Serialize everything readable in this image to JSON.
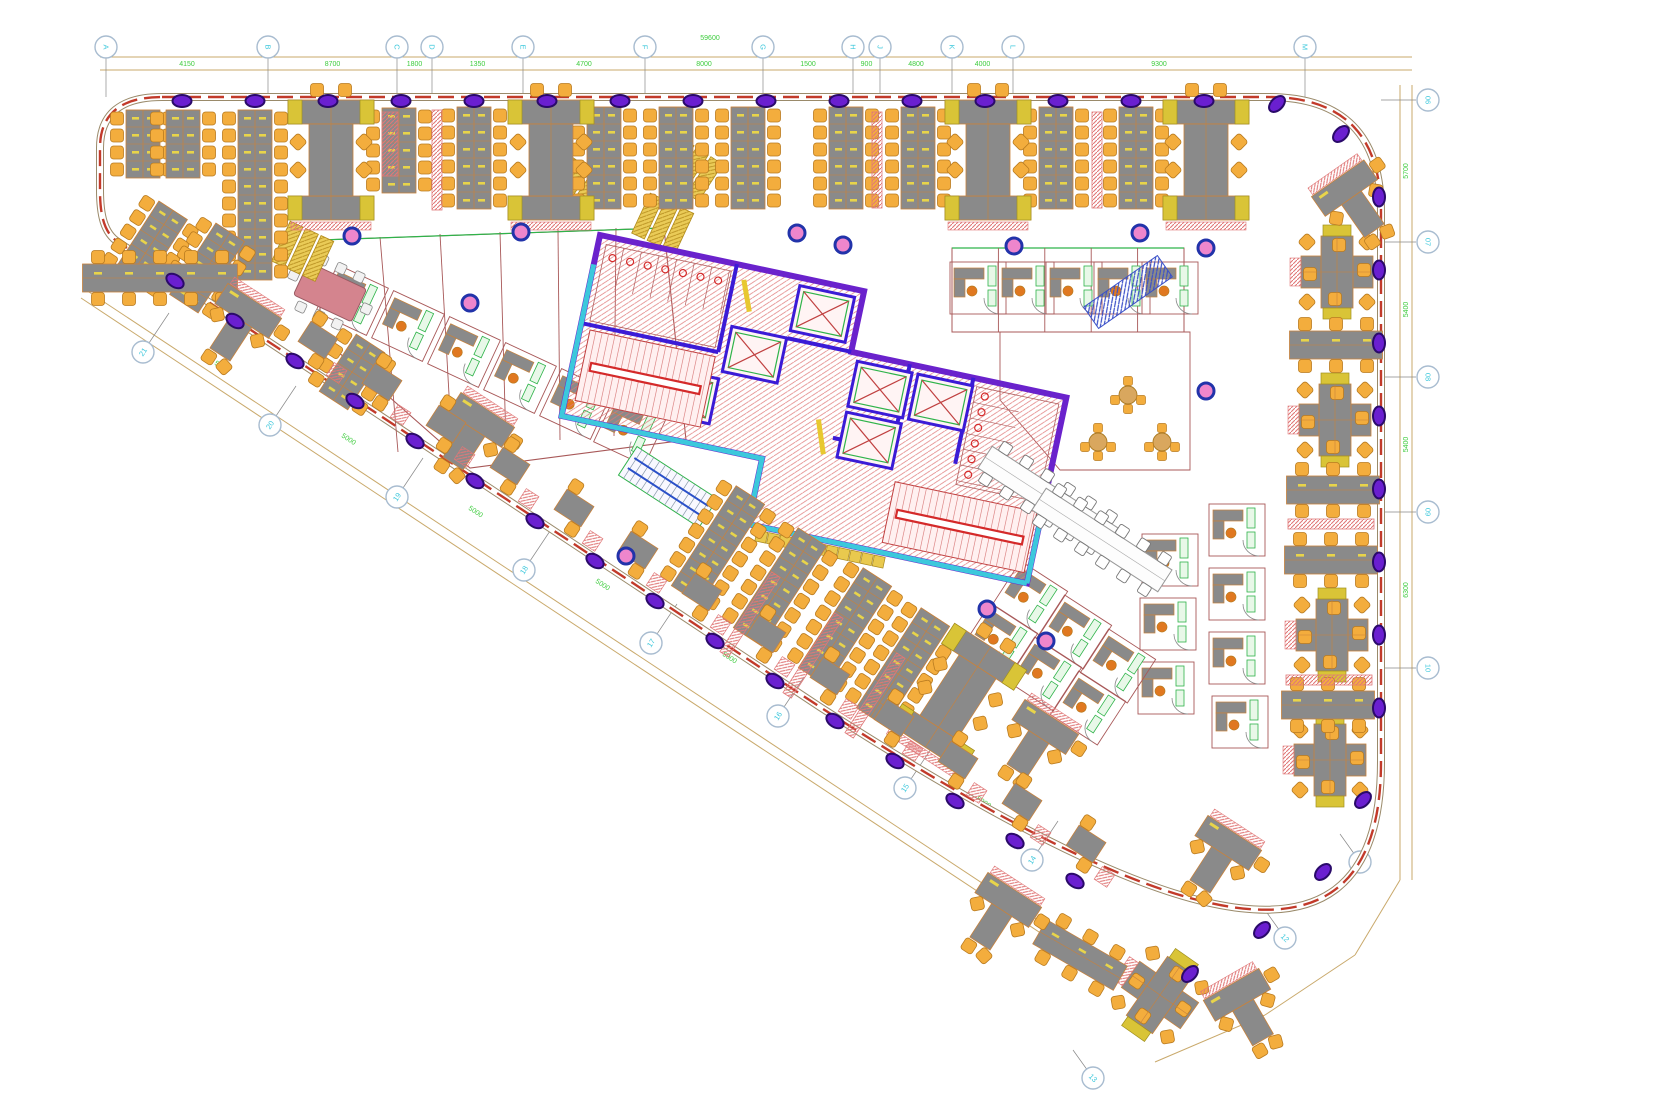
{
  "drawing": {
    "type": "office-floor-plan",
    "units_note": "CAD plan, no visible title block"
  },
  "colors": {
    "wall_edge": "#9a8a6a",
    "wall_dash": "#c23a2a",
    "dim_line": "#c9a96b",
    "dim_text": "#3ecc3e",
    "bubble_stroke": "#a8bcd0",
    "bubble_text": "#3ec8dc",
    "col_purple_fill": "#6a1fd0",
    "col_purple_stroke": "#2a0a6a",
    "pink_col_fill": "#ee86cc",
    "pink_col_stroke": "#2233aa",
    "desk": "#8a8a8a",
    "desk_stroke": "#c8823c",
    "chair": "#f3ad3d",
    "chair_stroke": "#b97b20",
    "wedge": "#d9c437",
    "wedge_stroke": "#a09020",
    "hatch_pink": "#e07878",
    "core_wall": "#6a22cc",
    "core_wall2": "#3b1bd6",
    "cyan": "#3cc8dc",
    "stair_red": "#d42a2a",
    "green": "#2fb34a",
    "green_fill": "#e8f8e8",
    "office_wall": "#a85858",
    "pink_table": "#d4848e",
    "yellow_shelf": "#eacb57",
    "yellow_dash": "#e8c830",
    "locker": "#e9c94e",
    "tick": "#888888"
  },
  "grid": {
    "top": {
      "bubble_y": 47,
      "line_y1": 57,
      "line_y2": 70,
      "x_start": 100,
      "x_end": 1412,
      "bubbles": [
        {
          "x": 106,
          "label": "A"
        },
        {
          "x": 268,
          "label": "B"
        },
        {
          "x": 397,
          "label": "C"
        },
        {
          "x": 432,
          "label": "D"
        },
        {
          "x": 523,
          "label": "E"
        },
        {
          "x": 645,
          "label": "F"
        },
        {
          "x": 763,
          "label": "G"
        },
        {
          "x": 853,
          "label": "H"
        },
        {
          "x": 880,
          "label": "J"
        },
        {
          "x": 952,
          "label": "K"
        },
        {
          "x": 1013,
          "label": "L"
        },
        {
          "x": 1305,
          "label": "M"
        }
      ],
      "dims": [
        "4150",
        "8700",
        "1800",
        "1350",
        "4700",
        "8000",
        "1500",
        "900",
        "4800",
        "4000",
        "9300"
      ],
      "total": "59600"
    },
    "right": {
      "bubble_x": 1428,
      "line_x1": 1400,
      "line_x2": 1412,
      "y_start": 85,
      "y_end": 880,
      "bubbles": [
        {
          "y": 100,
          "label": "06"
        },
        {
          "y": 242,
          "label": "07"
        },
        {
          "y": 377,
          "label": "08"
        },
        {
          "y": 512,
          "label": "09"
        },
        {
          "y": 668,
          "label": "10"
        }
      ],
      "dims": [
        "5700",
        "5400",
        "5400",
        "6300"
      ]
    },
    "corner": {
      "bubbles": [
        {
          "x": 1360,
          "y": 862,
          "label": "11"
        },
        {
          "x": 1285,
          "y": 938,
          "label": "12"
        },
        {
          "x": 1093,
          "y": 1078,
          "label": "13"
        }
      ]
    },
    "diag": {
      "angle": 33.5,
      "bubbles": [
        {
          "x": 143,
          "y": 352,
          "label": "21"
        },
        {
          "x": 270,
          "y": 425,
          "label": "20"
        },
        {
          "x": 397,
          "y": 497,
          "label": "19"
        },
        {
          "x": 524,
          "y": 570,
          "label": "18"
        },
        {
          "x": 651,
          "y": 643,
          "label": "17"
        },
        {
          "x": 778,
          "y": 716,
          "label": "16"
        },
        {
          "x": 905,
          "y": 788,
          "label": "15"
        },
        {
          "x": 1032,
          "y": 860,
          "label": "14"
        }
      ],
      "dims": [
        "5000",
        "5000",
        "5000",
        "5000",
        "5000",
        "5000",
        "5000"
      ]
    }
  },
  "columns": {
    "top": {
      "y": 101,
      "xs": [
        182,
        255,
        328,
        401,
        474,
        547,
        620,
        693,
        766,
        839,
        912,
        985,
        1058,
        1131,
        1204
      ]
    },
    "corner_top": [
      [
        1277,
        104
      ],
      [
        1341,
        134
      ]
    ],
    "right": {
      "x": 1379,
      "ys": [
        197,
        270,
        343,
        416,
        489,
        562,
        635,
        708
      ]
    },
    "curve": [
      [
        1363,
        800
      ],
      [
        1323,
        872
      ],
      [
        1262,
        930
      ],
      [
        1190,
        974
      ]
    ],
    "diag": {
      "start_x": 175,
      "start_y": 281,
      "dx": 60,
      "dy": 40,
      "n": 16
    }
  },
  "pink_columns": [
    [
      352,
      236
    ],
    [
      521,
      232
    ],
    [
      797,
      233
    ],
    [
      843,
      245
    ],
    [
      1014,
      246
    ],
    [
      1140,
      233
    ],
    [
      1206,
      248
    ],
    [
      470,
      303
    ],
    [
      1206,
      391
    ],
    [
      626,
      556
    ],
    [
      987,
      609
    ],
    [
      1046,
      641
    ]
  ],
  "clusters": {
    "vstrips": [
      {
        "x": 143,
        "y": 110,
        "rows": 4
      },
      {
        "x": 183,
        "y": 110,
        "rows": 4
      },
      {
        "x": 255,
        "y": 110,
        "rows": 10
      },
      {
        "x": 399,
        "y": 108,
        "rows": 5
      },
      {
        "x": 474,
        "y": 107,
        "rows": 6
      },
      {
        "x": 604,
        "y": 107,
        "rows": 6
      },
      {
        "x": 676,
        "y": 107,
        "rows": 6
      },
      {
        "x": 748,
        "y": 107,
        "rows": 6
      },
      {
        "x": 846,
        "y": 107,
        "rows": 6
      },
      {
        "x": 918,
        "y": 107,
        "rows": 6
      },
      {
        "x": 1056,
        "y": 107,
        "rows": 6
      },
      {
        "x": 1136,
        "y": 107,
        "rows": 6
      }
    ],
    "iclusters": [
      {
        "x": 331,
        "y": 160,
        "r": 0
      },
      {
        "x": 551,
        "y": 160,
        "r": 0
      },
      {
        "x": 988,
        "y": 160,
        "r": 0
      },
      {
        "x": 1206,
        "y": 160,
        "r": 0
      },
      {
        "x": 958,
        "y": 697,
        "r": 33
      }
    ],
    "pink_strips": [
      {
        "x": 390,
        "y": 112,
        "w": 16,
        "h": 64,
        "r": 0
      },
      {
        "x": 437,
        "y": 110,
        "w": 10,
        "h": 100,
        "r": 0
      },
      {
        "x": 877,
        "y": 112,
        "w": 10,
        "h": 96,
        "r": 0
      },
      {
        "x": 1097,
        "y": 112,
        "w": 10,
        "h": 96,
        "r": 0
      }
    ],
    "rot_strips": [
      {
        "x": 150,
        "y": 246,
        "r": 33,
        "rows": 5
      },
      {
        "x": 207,
        "y": 268,
        "r": 33,
        "rows": 5
      },
      {
        "x": 352,
        "y": 372,
        "r": 33,
        "rows": 4
      },
      {
        "x": 718,
        "y": 545,
        "r": 33,
        "rows": 7
      },
      {
        "x": 780,
        "y": 587,
        "r": 33,
        "rows": 7
      },
      {
        "x": 845,
        "y": 627,
        "r": 33,
        "rows": 7
      },
      {
        "x": 903,
        "y": 667,
        "r": 33,
        "rows": 7
      }
    ],
    "rot_pinks": [
      {
        "x": 750,
        "y": 567,
        "w": 10,
        "h": 95,
        "r": 33
      },
      {
        "x": 813,
        "y": 608,
        "w": 10,
        "h": 95,
        "r": 33
      },
      {
        "x": 875,
        "y": 648,
        "w": 10,
        "h": 95,
        "r": 33
      }
    ],
    "tclusters": [
      {
        "x": 245,
        "y": 316,
        "r": 33
      },
      {
        "x": 478,
        "y": 425,
        "r": 33
      },
      {
        "x": 1348,
        "y": 193,
        "r": -35
      },
      {
        "x": 1042,
        "y": 732,
        "r": 33
      },
      {
        "x": 1225,
        "y": 848,
        "r": 33
      },
      {
        "x": 1005,
        "y": 905,
        "r": 33
      },
      {
        "x": 1240,
        "y": 1000,
        "r": -30
      }
    ],
    "xclusters": [
      {
        "x": 1337,
        "y": 272,
        "r": 0
      },
      {
        "x": 1335,
        "y": 420,
        "r": 0
      },
      {
        "x": 1332,
        "y": 635,
        "r": 0
      },
      {
        "x": 1330,
        "y": 760,
        "r": 0
      },
      {
        "x": 1160,
        "y": 995,
        "r": 35
      }
    ],
    "row6": [
      {
        "x": 1336,
        "y": 345,
        "r": 0
      },
      {
        "x": 1333,
        "y": 490,
        "r": 0
      },
      {
        "x": 1331,
        "y": 560,
        "r": 0
      },
      {
        "x": 1328,
        "y": 705,
        "r": 0
      },
      {
        "x": 1080,
        "y": 955,
        "r": 30
      }
    ],
    "row8": [
      {
        "x": 160,
        "y": 278,
        "r": 0
      }
    ],
    "pink_rows": [
      {
        "x": 1331,
        "y": 524,
        "w": 86,
        "h": 10,
        "r": 0
      },
      {
        "x": 1329,
        "y": 680,
        "w": 86,
        "h": 10,
        "r": 0
      }
    ],
    "pairs": {
      "start_x": 318,
      "start_y": 340,
      "dx": 64,
      "dy": 42,
      "n": 13,
      "r": 33
    },
    "cubicle_rows": [
      {
        "x": 1048,
        "y": 498,
        "r": 33
      },
      {
        "x": 1102,
        "y": 540,
        "r": 33
      }
    ],
    "round_tables": [
      [
        1128,
        395
      ],
      [
        1098,
        442
      ],
      [
        1162,
        442
      ]
    ],
    "meeting_table": {
      "x": 330,
      "y": 292,
      "r": 25
    }
  },
  "offices": {
    "left_block": {
      "outline": [
        [
          320,
          240
        ],
        [
          664,
          228
        ],
        [
          686,
          440
        ],
        [
          470,
          468
        ],
        [
          320,
          336
        ]
      ],
      "dividers": [
        [
          380,
          237,
          398,
          452
        ],
        [
          440,
          234,
          452,
          448
        ],
        [
          500,
          232,
          506,
          444
        ],
        [
          558,
          230,
          560,
          440
        ],
        [
          616,
          228,
          614,
          436
        ]
      ],
      "cells": [
        {
          "x": 352,
          "y": 300,
          "r": 25
        },
        {
          "x": 408,
          "y": 326,
          "r": 25
        },
        {
          "x": 464,
          "y": 352,
          "r": 25
        },
        {
          "x": 520,
          "y": 378,
          "r": 25
        },
        {
          "x": 576,
          "y": 404,
          "r": 25
        },
        {
          "x": 630,
          "y": 430,
          "r": 25
        }
      ]
    },
    "phone_rooms": {
      "rect": [
        952,
        248,
        232,
        84
      ],
      "cells": [
        {
          "x": 978,
          "y": 288,
          "r": 0
        },
        {
          "x": 1026,
          "y": 288,
          "r": 0
        },
        {
          "x": 1074,
          "y": 288,
          "r": 0
        },
        {
          "x": 1122,
          "y": 288,
          "r": 0
        },
        {
          "x": 1170,
          "y": 288,
          "r": 0
        }
      ]
    },
    "right_cells": [
      {
        "x": 1237,
        "y": 530,
        "r": 0
      },
      {
        "x": 1237,
        "y": 594,
        "r": 0
      },
      {
        "x": 1237,
        "y": 658,
        "r": 0
      },
      {
        "x": 1240,
        "y": 722,
        "r": 0
      },
      {
        "x": 1170,
        "y": 560,
        "r": 0
      },
      {
        "x": 1168,
        "y": 624,
        "r": 0
      },
      {
        "x": 1166,
        "y": 688,
        "r": 0
      }
    ],
    "bottom_cells": [
      {
        "x": 1030,
        "y": 598,
        "r": 33
      },
      {
        "x": 1074,
        "y": 632,
        "r": 33
      },
      {
        "x": 1118,
        "y": 666,
        "r": 33
      },
      {
        "x": 1000,
        "y": 640,
        "r": 33
      },
      {
        "x": 1044,
        "y": 674,
        "r": 33
      },
      {
        "x": 1088,
        "y": 708,
        "r": 33
      }
    ],
    "shelves": [
      {
        "x": 570,
        "y": 182,
        "r": 33
      },
      {
        "x": 688,
        "y": 168,
        "r": 33
      },
      {
        "x": 300,
        "y": 250,
        "r": 25
      },
      {
        "x": 660,
        "y": 222,
        "r": 25
      }
    ],
    "stair2": {
      "x": 668,
      "y": 487,
      "r": 33
    },
    "escalator": {
      "x": 1128,
      "y": 292,
      "r": -35
    }
  },
  "core": {
    "x": 600,
    "y": 235,
    "rot": 12
  }
}
